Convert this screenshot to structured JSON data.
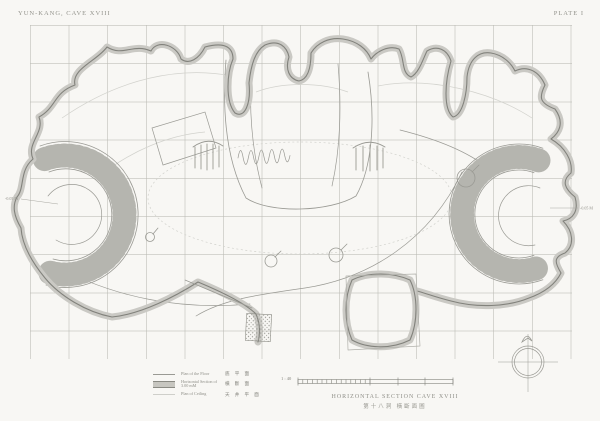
{
  "header": {
    "title_left": "YUN-KANG, CAVE XVIII",
    "plate_label": "PLATE I"
  },
  "drawing": {
    "subject": "horizontal section plan of cave XVIII with floor and ceiling plans overlaid",
    "elevation_marks": {
      "left": "-0.05 M",
      "right": "-0.05 M"
    }
  },
  "legend": {
    "items": [
      {
        "en": "Plan of the Floor",
        "cn": "底 平 面",
        "swatch": "floor-line"
      },
      {
        "en": "Horizontal Section of 3.00 mM",
        "cn": "橫 斷 面",
        "swatch": "section-band"
      },
      {
        "en": "Plan of Ceiling",
        "cn": "天 井 平 面",
        "swatch": "ceiling-line"
      }
    ]
  },
  "scale_bar": {
    "ratio": "1 : 40"
  },
  "caption": {
    "en": "HORIZONTAL SECTION CAVE XVIII",
    "cn": "第十八洞 橫斷面圖"
  },
  "colors": {
    "paper": "#f8f7f4",
    "grid": "#dcdcd8",
    "wall_band_fill": "#cac9c4",
    "wall_band_edge": "#82827c",
    "floor_line": "#9a9a94",
    "ceiling_line": "#d2d2cd",
    "text": "#8f8f88"
  }
}
